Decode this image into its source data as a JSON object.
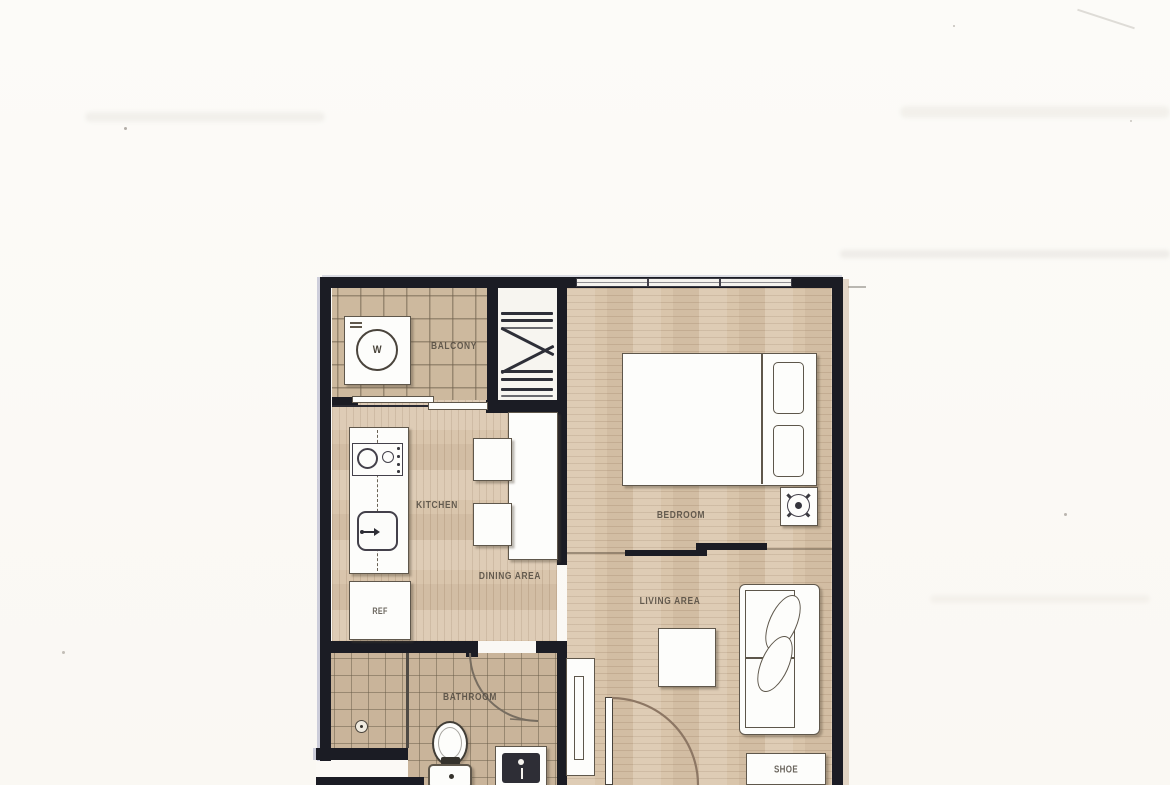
{
  "document": {
    "type": "scanned apartment floor plan",
    "background_color": "#fbf9f5"
  },
  "colors": {
    "wall": "#1b1c24",
    "wood_floor": "#d9c5ab",
    "balcony_tile": "#cdb99e",
    "bathroom_tile": "#c9b49a",
    "furniture_fill": "#fdfdfb",
    "furniture_outline": "#5f574b",
    "label_text": "#4b443b",
    "door_arc": "#8d7764"
  },
  "rooms": {
    "balcony": {
      "label": "BALCONY"
    },
    "kitchen": {
      "label": "KITCHEN"
    },
    "dining": {
      "label": "DINING AREA"
    },
    "bedroom": {
      "label": "BEDROOM"
    },
    "living": {
      "label": "LIVING AREA"
    },
    "bathroom": {
      "label": "BATHROOM"
    }
  },
  "fixtures": {
    "washer": {
      "label": "W"
    },
    "refrigerator": {
      "label": "REF"
    },
    "shoe_cabinet": {
      "label": "SHOE"
    }
  }
}
